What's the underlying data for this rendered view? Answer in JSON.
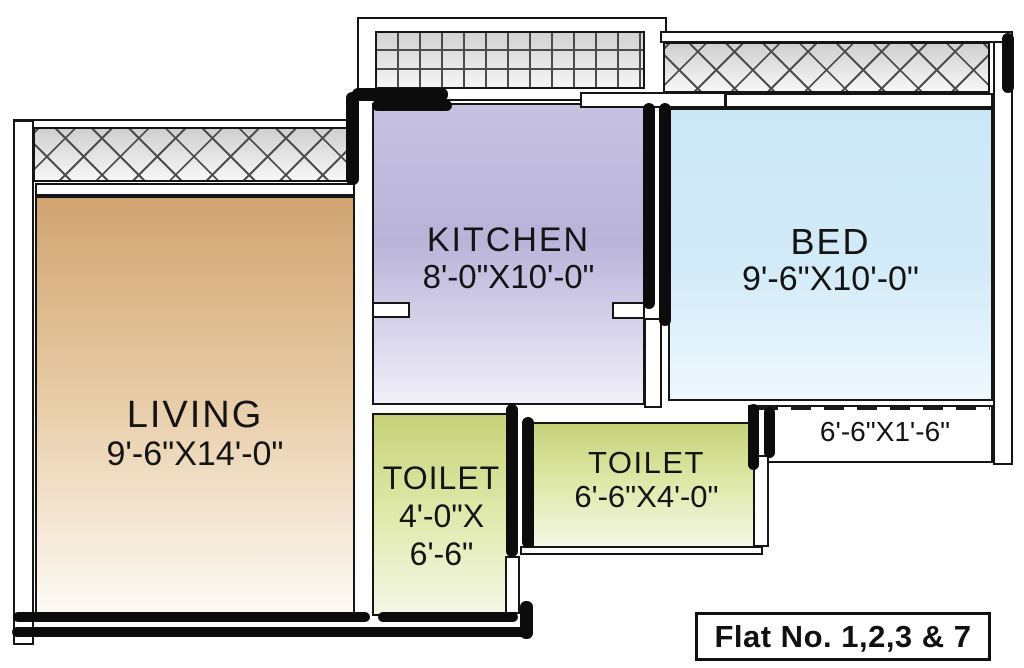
{
  "plan": {
    "rooms": {
      "living": {
        "name": "LIVING",
        "dims": "9'-6\"X14'-0\""
      },
      "kitchen": {
        "name": "KITCHEN",
        "dims": "8'-0\"X10'-0\""
      },
      "bed": {
        "name": "BED",
        "dims": "9'-6\"X10'-0\""
      },
      "toilet1": {
        "name": "TOILET",
        "dims_line1": "4'-0\"X",
        "dims_line2": "6'-6\""
      },
      "toilet2": {
        "name": "TOILET",
        "dims": "6'-6\"X4'-0\""
      },
      "balcony_right": {
        "dims": "6'-6\"X1'-6\""
      }
    },
    "footer": {
      "flat_label": "Flat No. 1,2,3 & 7"
    },
    "colors": {
      "living_top": "#d0a471",
      "living_bottom": "#fdfaf5",
      "kitchen_top": "#c7c2e2",
      "kitchen_bottom": "#f0eff8",
      "bed_top": "#cbe7f6",
      "bed_bottom": "#eef8fd",
      "toilet_top": "#c6d278",
      "toilet_bottom": "#f4f7e6",
      "wall_line": "#141414"
    }
  }
}
